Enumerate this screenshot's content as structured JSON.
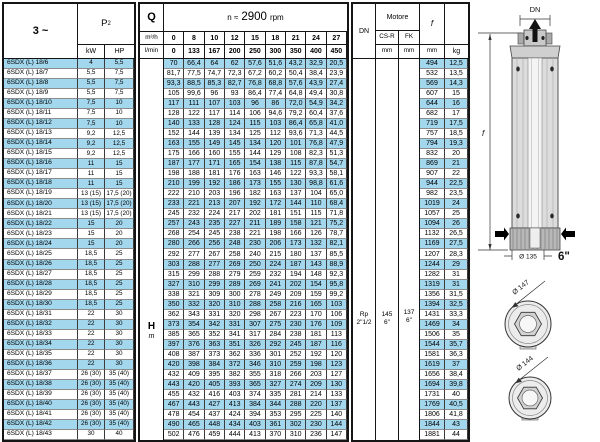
{
  "colors": {
    "stripe": "#a2d7ee"
  },
  "power_table": {
    "phase": "3 ~",
    "p2_main": "P",
    "p2_sub": "2",
    "kw": "kW",
    "hp": "HP"
  },
  "flow_table": {
    "q": "Q",
    "m3h": "m³/h",
    "lmin": "l/min",
    "rpm_prefix": "n ≈",
    "rpm_value": "2900",
    "rpm_suffix": "rpm",
    "m3h_values": [
      "0",
      "8",
      "10",
      "12",
      "15",
      "18",
      "21",
      "24",
      "27"
    ],
    "lmin_values": [
      "0",
      "133",
      "167",
      "200",
      "250",
      "300",
      "350",
      "400",
      "450"
    ],
    "h_label": "H",
    "h_unit": "m"
  },
  "dim_table": {
    "dn": "DN",
    "motore": "Motore",
    "csr": "CS-R",
    "fk": "FK",
    "mm": "mm",
    "f": "f",
    "kg": "kg",
    "dn_value_1": "Rp",
    "dn_value_2": "2\"1/2",
    "csr_value_1": "145",
    "csr_value_2": "6\"",
    "fk_value_1": "137",
    "fk_value_2": "6\""
  },
  "rows": [
    {
      "model": "6SDX (L) 18/6",
      "kw": "4",
      "hp": "5,5",
      "h": [
        "70",
        "66,4",
        "64",
        "62",
        "57,6",
        "51,6",
        "43,2",
        "32,9",
        "20,5"
      ],
      "f": "494",
      "kg": "12,5"
    },
    {
      "model": "6SDX (L) 18/7",
      "kw": "5,5",
      "hp": "7,5",
      "h": [
        "81,7",
        "77,5",
        "74,7",
        "72,3",
        "67,2",
        "60,2",
        "50,4",
        "38,4",
        "23,9"
      ],
      "f": "532",
      "kg": "13,5"
    },
    {
      "model": "6SDX (L) 18/8",
      "kw": "5,5",
      "hp": "7,5",
      "h": [
        "93,3",
        "88,5",
        "85,3",
        "82,7",
        "76,8",
        "68,8",
        "57,6",
        "43,9",
        "27,4"
      ],
      "f": "569",
      "kg": "14,3"
    },
    {
      "model": "6SDX (L) 18/9",
      "kw": "5,5",
      "hp": "7,5",
      "h": [
        "105",
        "99,6",
        "96",
        "93",
        "86,4",
        "77,4",
        "64,8",
        "49,4",
        "30,8"
      ],
      "f": "607",
      "kg": "15"
    },
    {
      "model": "6SDX (L) 18/10",
      "kw": "7,5",
      "hp": "10",
      "h": [
        "117",
        "111",
        "107",
        "103",
        "96",
        "86",
        "72,0",
        "54,9",
        "34,2"
      ],
      "f": "644",
      "kg": "16"
    },
    {
      "model": "6SDX (L) 18/11",
      "kw": "7,5",
      "hp": "10",
      "h": [
        "128",
        "122",
        "117",
        "114",
        "106",
        "94,6",
        "79,2",
        "60,4",
        "37,6"
      ],
      "f": "682",
      "kg": "17"
    },
    {
      "model": "6SDX (L) 18/12",
      "kw": "7,5",
      "hp": "10",
      "h": [
        "140",
        "133",
        "128",
        "124",
        "115",
        "103",
        "86,4",
        "65,8",
        "41,0"
      ],
      "f": "719",
      "kg": "17,5"
    },
    {
      "model": "6SDX (L) 18/13",
      "kw": "9,2",
      "hp": "12,5",
      "h": [
        "152",
        "144",
        "139",
        "134",
        "125",
        "112",
        "93,6",
        "71,3",
        "44,5"
      ],
      "f": "757",
      "kg": "18,5"
    },
    {
      "model": "6SDX (L) 18/14",
      "kw": "9,2",
      "hp": "12,5",
      "h": [
        "163",
        "155",
        "149",
        "145",
        "134",
        "120",
        "101",
        "76,8",
        "47,9"
      ],
      "f": "794",
      "kg": "19,3"
    },
    {
      "model": "6SDX (L) 18/15",
      "kw": "9,2",
      "hp": "12,5",
      "h": [
        "175",
        "166",
        "160",
        "155",
        "144",
        "129",
        "108",
        "82,3",
        "51,3"
      ],
      "f": "832",
      "kg": "20"
    },
    {
      "model": "6SDX (L) 18/16",
      "kw": "11",
      "hp": "15",
      "h": [
        "187",
        "177",
        "171",
        "165",
        "154",
        "138",
        "115",
        "87,8",
        "54,7"
      ],
      "f": "869",
      "kg": "21"
    },
    {
      "model": "6SDX (L) 18/17",
      "kw": "11",
      "hp": "15",
      "h": [
        "198",
        "188",
        "181",
        "176",
        "163",
        "146",
        "122",
        "93,3",
        "58,1"
      ],
      "f": "907",
      "kg": "22"
    },
    {
      "model": "6SDX (L) 18/18",
      "kw": "11",
      "hp": "15",
      "h": [
        "210",
        "199",
        "192",
        "186",
        "173",
        "155",
        "130",
        "98,8",
        "61,6"
      ],
      "f": "944",
      "kg": "22,5"
    },
    {
      "model": "6SDX (L) 18/19",
      "kw": "13 (15)",
      "hp": "17,5 (20)",
      "h": [
        "222",
        "210",
        "203",
        "196",
        "182",
        "163",
        "137",
        "104",
        "65,0"
      ],
      "f": "982",
      "kg": "23,5"
    },
    {
      "model": "6SDX (L) 18/20",
      "kw": "13 (15)",
      "hp": "17,5 (20)",
      "h": [
        "233",
        "221",
        "213",
        "207",
        "192",
        "172",
        "144",
        "110",
        "68,4"
      ],
      "f": "1019",
      "kg": "24"
    },
    {
      "model": "6SDX (L) 18/21",
      "kw": "13 (15)",
      "hp": "17,5 (20)",
      "h": [
        "245",
        "232",
        "224",
        "217",
        "202",
        "181",
        "151",
        "115",
        "71,8"
      ],
      "f": "1057",
      "kg": "25"
    },
    {
      "model": "6SDX (L) 18/22",
      "kw": "15",
      "hp": "20",
      "h": [
        "257",
        "243",
        "235",
        "227",
        "211",
        "189",
        "158",
        "121",
        "75,2"
      ],
      "f": "1094",
      "kg": "26"
    },
    {
      "model": "6SDX (L) 18/23",
      "kw": "15",
      "hp": "20",
      "h": [
        "268",
        "254",
        "245",
        "238",
        "221",
        "198",
        "166",
        "126",
        "78,7"
      ],
      "f": "1132",
      "kg": "26,5"
    },
    {
      "model": "6SDX (L) 18/24",
      "kw": "15",
      "hp": "20",
      "h": [
        "280",
        "266",
        "256",
        "248",
        "230",
        "206",
        "173",
        "132",
        "82,1"
      ],
      "f": "1169",
      "kg": "27,5"
    },
    {
      "model": "6SDX (L) 18/25",
      "kw": "18,5",
      "hp": "25",
      "h": [
        "292",
        "277",
        "267",
        "258",
        "240",
        "215",
        "180",
        "137",
        "85,5"
      ],
      "f": "1207",
      "kg": "28,3"
    },
    {
      "model": "6SDX (L) 18/26",
      "kw": "18,5",
      "hp": "25",
      "h": [
        "303",
        "288",
        "277",
        "269",
        "250",
        "224",
        "187",
        "143",
        "88,9"
      ],
      "f": "1244",
      "kg": "29"
    },
    {
      "model": "6SDX (L) 18/27",
      "kw": "18,5",
      "hp": "25",
      "h": [
        "315",
        "299",
        "288",
        "279",
        "259",
        "232",
        "194",
        "148",
        "92,3"
      ],
      "f": "1282",
      "kg": "31"
    },
    {
      "model": "6SDX (L) 18/28",
      "kw": "18,5",
      "hp": "25",
      "h": [
        "327",
        "310",
        "299",
        "289",
        "269",
        "241",
        "202",
        "154",
        "95,8"
      ],
      "f": "1319",
      "kg": "31"
    },
    {
      "model": "6SDX (L) 18/29",
      "kw": "18,5",
      "hp": "25",
      "h": [
        "338",
        "321",
        "309",
        "300",
        "278",
        "249",
        "209",
        "159",
        "99,2"
      ],
      "f": "1356",
      "kg": "31,5"
    },
    {
      "model": "6SDX (L) 18/30",
      "kw": "18,5",
      "hp": "25",
      "h": [
        "350",
        "332",
        "320",
        "310",
        "288",
        "258",
        "216",
        "165",
        "103"
      ],
      "f": "1394",
      "kg": "32,5"
    },
    {
      "model": "6SDX (L) 18/31",
      "kw": "22",
      "hp": "30",
      "h": [
        "362",
        "343",
        "331",
        "320",
        "298",
        "267",
        "223",
        "170",
        "106"
      ],
      "f": "1431",
      "kg": "33,3"
    },
    {
      "model": "6SDX (L) 18/32",
      "kw": "22",
      "hp": "30",
      "h": [
        "373",
        "354",
        "342",
        "331",
        "307",
        "275",
        "230",
        "176",
        "109"
      ],
      "f": "1469",
      "kg": "34"
    },
    {
      "model": "6SDX (L) 18/33",
      "kw": "22",
      "hp": "30",
      "h": [
        "385",
        "365",
        "352",
        "341",
        "317",
        "284",
        "238",
        "181",
        "113"
      ],
      "f": "1506",
      "kg": "35"
    },
    {
      "model": "6SDX (L) 18/34",
      "kw": "22",
      "hp": "30",
      "h": [
        "397",
        "376",
        "363",
        "351",
        "326",
        "292",
        "245",
        "187",
        "116"
      ],
      "f": "1544",
      "kg": "35,7"
    },
    {
      "model": "6SDX (L) 18/35",
      "kw": "22",
      "hp": "30",
      "h": [
        "408",
        "387",
        "373",
        "362",
        "336",
        "301",
        "252",
        "192",
        "120"
      ],
      "f": "1581",
      "kg": "36,3"
    },
    {
      "model": "6SDX (L) 18/36",
      "kw": "22",
      "hp": "30",
      "h": [
        "420",
        "398",
        "384",
        "372",
        "346",
        "310",
        "259",
        "198",
        "123"
      ],
      "f": "1619",
      "kg": "37"
    },
    {
      "model": "6SDX (L) 18/37",
      "kw": "26 (30)",
      "hp": "35 (40)",
      "h": [
        "432",
        "409",
        "395",
        "382",
        "355",
        "318",
        "266",
        "203",
        "127"
      ],
      "f": "1656",
      "kg": "38,4"
    },
    {
      "model": "6SDX (L) 18/38",
      "kw": "26 (30)",
      "hp": "35 (40)",
      "h": [
        "443",
        "420",
        "405",
        "393",
        "365",
        "327",
        "274",
        "209",
        "130"
      ],
      "f": "1694",
      "kg": "39,8"
    },
    {
      "model": "6SDX (L) 18/39",
      "kw": "26 (30)",
      "hp": "35 (40)",
      "h": [
        "455",
        "432",
        "416",
        "403",
        "374",
        "335",
        "281",
        "214",
        "133"
      ],
      "f": "1731",
      "kg": "40"
    },
    {
      "model": "6SDX (L) 18/40",
      "kw": "26 (30)",
      "hp": "35 (40)",
      "h": [
        "467",
        "443",
        "427",
        "413",
        "384",
        "344",
        "288",
        "220",
        "137"
      ],
      "f": "1769",
      "kg": "40,5"
    },
    {
      "model": "6SDX (L) 18/41",
      "kw": "26 (30)",
      "hp": "35 (40)",
      "h": [
        "478",
        "454",
        "437",
        "424",
        "394",
        "353",
        "295",
        "225",
        "140"
      ],
      "f": "1806",
      "kg": "41,8"
    },
    {
      "model": "6SDX (L) 18/42",
      "kw": "26 (30)",
      "hp": "35 (40)",
      "h": [
        "490",
        "465",
        "448",
        "434",
        "403",
        "361",
        "302",
        "230",
        "144"
      ],
      "f": "1844",
      "kg": "43"
    },
    {
      "model": "6SDX (L) 18/43",
      "kw": "30",
      "hp": "40",
      "h": [
        "502",
        "476",
        "459",
        "444",
        "413",
        "370",
        "310",
        "236",
        "147"
      ],
      "f": "1881",
      "kg": "44"
    }
  ],
  "diagram": {
    "dn": "DN",
    "f": "f",
    "d135": "Ø 135",
    "size": "6\"",
    "d147": "Ø 147",
    "d144": "Ø 144"
  }
}
